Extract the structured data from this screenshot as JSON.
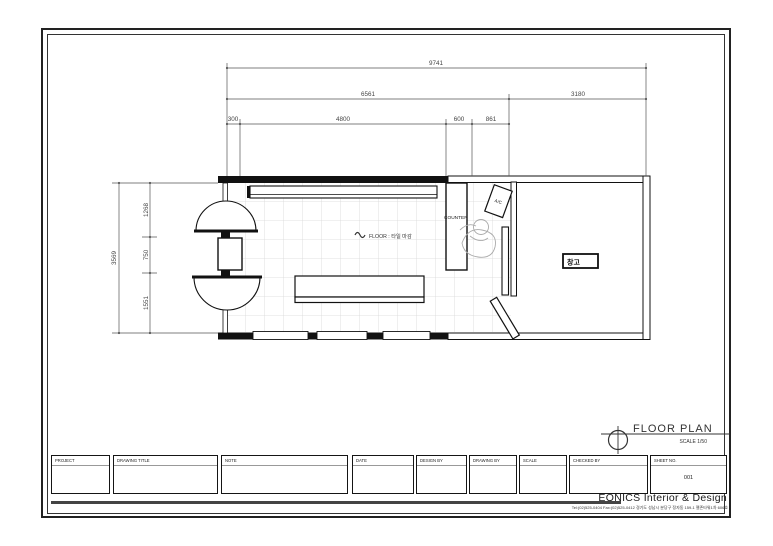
{
  "sheet": {
    "company": "EONICS Interior & Design",
    "contact": "Tel:(02)525-0404  Fax:(02)525-0412   경기도 성남시 분당구 정자동 159-1 젤존타워1차 606호",
    "sheet_no": "001"
  },
  "drawing_title": {
    "label": "FLOOR PLAN",
    "scale": "SCALE  1/50"
  },
  "title_block": {
    "fields": [
      "PROJECT",
      "DRAWING TITLE",
      "NOTE",
      "DATE",
      "DESIGN BY",
      "DRAWING BY",
      "SCALE",
      "CHECKED BY",
      "SHEET NO."
    ]
  },
  "dimensions": {
    "top": {
      "overall": "9741",
      "left_span": "6561",
      "right_span": "3180",
      "detail": [
        "300",
        "4800",
        "600",
        "861"
      ]
    },
    "left": {
      "overall": "3569",
      "segments": [
        "1268",
        "750",
        "1551"
      ]
    }
  },
  "plan": {
    "floor_label": "FLOOR : 타일 마감",
    "counter": "COUNTER",
    "ac": "A/C",
    "storage_sign": "창고"
  }
}
